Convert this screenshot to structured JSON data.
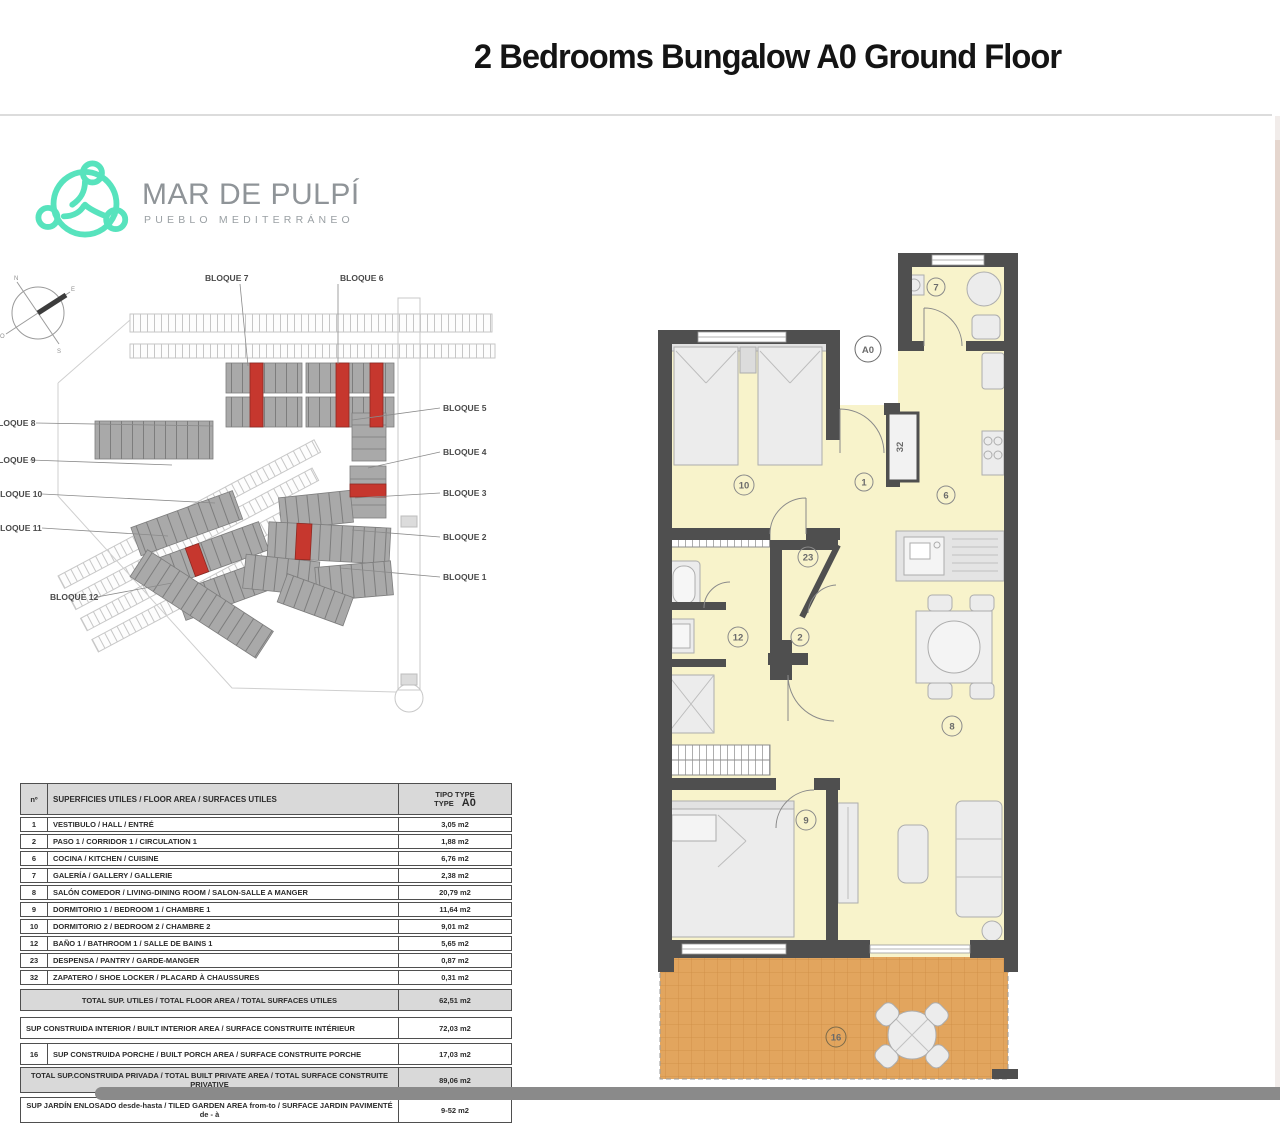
{
  "page": {
    "title": "2 Bedrooms Bungalow A0 Ground Floor"
  },
  "logo": {
    "name": "MAR DE PULPÍ",
    "tagline": "PUEBLO MEDITERRÁNEO",
    "accent_color": "#57e3bd",
    "text_color": "#8f9498"
  },
  "site_plan": {
    "top_labels": [
      "BLOQUE 7",
      "BLOQUE 6"
    ],
    "left_labels": [
      "BLOQUE 8",
      "BLOQUE 9",
      "BLOQUE 10",
      "BLOQUE 11",
      "BLOQUE 12"
    ],
    "right_labels": [
      "BLOQUE 5",
      "BLOQUE 4",
      "BLOQUE 3",
      "BLOQUE 2",
      "BLOQUE 1"
    ],
    "highlight_color": "#c6372e",
    "building_color": "#a9a9a9"
  },
  "floor_plan": {
    "unit_label": "A0",
    "wall_color": "#4f4f4f",
    "floor_color": "#f8f3cb",
    "porch_color": "#e2a55e",
    "rooms": {
      "hall": "1",
      "corridor": "2",
      "kitchen": "6",
      "galeria": "7",
      "living": "8",
      "bedroom1": "9",
      "bedroom2": "10",
      "bathroom": "12",
      "pantry": "23",
      "shoe_locker": "32",
      "porch": "16"
    }
  },
  "area_table": {
    "header": {
      "num": "nº",
      "desc": "SUPERFICIES UTILES / FLOOR AREA / SURFACES UTILES",
      "tipo_line": "TIPO TYPE",
      "type_word": "TYPE",
      "type_value": "A0"
    },
    "rows": [
      {
        "num": "1",
        "desc": "VESTIBULO / HALL / ENTRÉ",
        "value": "3,05 m2"
      },
      {
        "num": "2",
        "desc": "PASO 1 / CORRIDOR 1 / CIRCULATION 1",
        "value": "1,88 m2"
      },
      {
        "num": "6",
        "desc": "COCINA / KITCHEN / CUISINE",
        "value": "6,76 m2"
      },
      {
        "num": "7",
        "desc": "GALERÍA / GALLERY / GALLERIE",
        "value": "2,38 m2"
      },
      {
        "num": "8",
        "desc": "SALÓN COMEDOR  / LIVING-DINING ROOM / SALON-SALLE A MANGER",
        "value": "20,79 m2"
      },
      {
        "num": "9",
        "desc": "DORMITORIO 1 / BEDROOM 1 / CHAMBRE 1",
        "value": "11,64 m2"
      },
      {
        "num": "10",
        "desc": "DORMITORIO 2 / BEDROOM 2 / CHAMBRE 2",
        "value": "9,01 m2"
      },
      {
        "num": "12",
        "desc": "BAÑO 1 / BATHROOM 1 / SALLE DE BAINS 1",
        "value": "5,65 m2"
      },
      {
        "num": "23",
        "desc": "DESPENSA / PANTRY / GARDE-MANGER",
        "value": "0,87 m2"
      },
      {
        "num": "32",
        "desc": "ZAPATERO / SHOE LOCKER / PLACARD À CHAUSSURES",
        "value": "0,31 m2"
      }
    ],
    "total": {
      "desc": "TOTAL SUP. UTILES / TOTAL FLOOR AREA / TOTAL SURFACES UTILES",
      "value": "62,51 m2"
    },
    "summary": [
      {
        "num": "",
        "desc": "SUP CONSTRUIDA INTERIOR / BUILT INTERIOR AREA /  SURFACE CONSTRUITE INTÉRIEUR",
        "value": "72,03 m2"
      },
      {
        "num": "16",
        "desc": "SUP CONSTRUIDA PORCHE  / BUILT PORCH  AREA / SURFACE CONSTRUITE PORCHE",
        "value": "17,03 m2"
      },
      {
        "num": "",
        "desc": "TOTAL SUP.CONSTRUIDA PRIVADA / TOTAL  BUILT PRIVATE AREA / TOTAL SURFACE CONSTRUITE PRIVATIVE",
        "value": "89,06 m2"
      },
      {
        "num": "",
        "desc": "SUP JARDÍN ENLOSADO desde-hasta / TILED GARDEN AREA from-to / SURFACE JARDIN PAVIMENTÉ  de - à",
        "value": "9-52 m2"
      }
    ]
  }
}
